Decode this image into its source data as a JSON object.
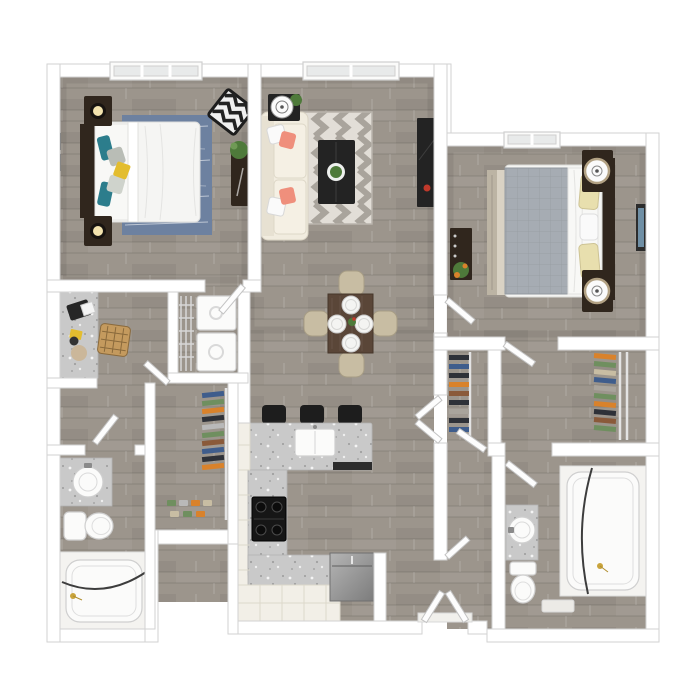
{
  "image": {
    "kind": "3d-rendered-floor-plan",
    "width": 697,
    "height": 697,
    "visible_text": "none"
  },
  "palette": {
    "wall": "#ffffff",
    "wallEdge": "#d2d2d2",
    "floor": "#9c958c",
    "granite": "#c9c9c9",
    "fixture": "#fbfbfa",
    "fixtureEdge": "#cfcfcf",
    "darkWood": "#30261d",
    "charcoal": "#232323",
    "cabinet": "#f2efe7",
    "cabinetEdge": "#dcd8cb",
    "duvetWhite": "#f5f5f3",
    "rugBlue": "#6d81a0",
    "pillowTeal": "#2c7d8c",
    "pillowYellow": "#e3bd2f",
    "pillowGray": "#b9bdb6",
    "sofaCream": "#f1ecdf",
    "pillowCoral": "#ef8f7c",
    "rugLight": "#e2ded7",
    "rugDark": "#a9a49c",
    "duvetGray": "#a6acb3",
    "pillowCream": "#e8dfae",
    "rugBeige": "#d9d2c4",
    "tableWood": "#5a4638",
    "chairBeige": "#c8bda3",
    "stool": "#1d1d1d",
    "steelLight": "#b5b5b5",
    "steelDark": "#7c7c7c",
    "plantGreen": "#4e7a3a",
    "accentOrange": "#d9822b",
    "accentRed": "#c0392b",
    "brassGold": "#c9a43c",
    "glass": "#e8eaea",
    "rattan": "#c49a5e",
    "clothesBlue": "#3f5d8c",
    "clothesGreen": "#6f8f5f",
    "clothesDark": "#2e3138"
  },
  "counts": {
    "bedrooms": 2,
    "bathrooms": 2,
    "windows": 3,
    "bar_stools": 3,
    "dining_chairs": 4,
    "place_settings": 4,
    "sofa_pillows": 4
  },
  "rooms": {
    "bedroom_1": {
      "furniture": [
        "bed with white duvet",
        "blue area rug",
        "2 nightstands with lamps",
        "chevron accent chair",
        "plant stand",
        "wall art",
        "window"
      ]
    },
    "living_room": {
      "furniture": [
        "cream sofa with coral pillows",
        "chevron rug",
        "dark coffee table with plant",
        "side table with lamp",
        "tv console",
        "window"
      ]
    },
    "bedroom_2": {
      "furniture": [
        "bed with gray duvet and cream pillows",
        "beige area rug",
        "2 nightstands with drum lamps",
        "dresser with plant",
        "wall art",
        "window"
      ]
    },
    "dining_area": {
      "furniture": [
        "walnut table",
        "4 beige chairs",
        "4 place settings",
        "centerpiece"
      ]
    },
    "kitchen": {
      "furniture": [
        "granite island with sink",
        "3 bar stools",
        "range",
        "refrigerator",
        "L-shaped counter with cabinets"
      ]
    },
    "desk_nook": {
      "furniture": [
        "granite desk",
        "laptop",
        "rattan chair",
        "note",
        "decor"
      ]
    },
    "laundry_closet": {
      "furniture": [
        "stacked washer and dryer",
        "wire shelving"
      ]
    },
    "walkin_closet_left": {
      "furniture": [
        "hanging clothes",
        "shoe rows",
        "wire rod"
      ]
    },
    "closet_a": {
      "furniture": [
        "hanging dark clothes"
      ]
    },
    "walkin_closet_right": {
      "furniture": [
        "hanging clothes",
        "wire rod"
      ]
    },
    "bathroom_1": {
      "furniture": [
        "granite vanity with round sink",
        "mirror",
        "toilet",
        "tub with curved curtain rod"
      ]
    },
    "bathroom_2": {
      "furniture": [
        "granite vanity with round sink",
        "toilet",
        "tub with curved curtain rod",
        "bath mat"
      ]
    },
    "entry": {
      "furniture": [
        "double entry doors",
        "threshold"
      ]
    }
  }
}
